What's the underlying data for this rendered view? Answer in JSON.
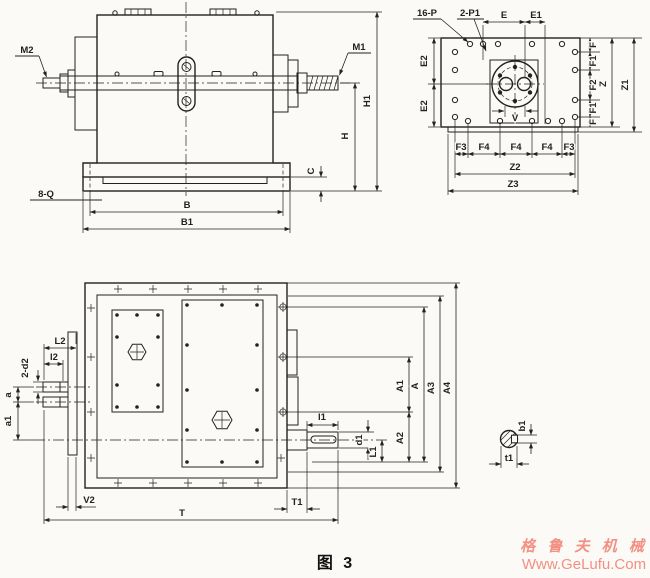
{
  "colors": {
    "line": "#222222",
    "paper": "#fbfaf7",
    "watermark": "#f29082"
  },
  "caption": "图 3",
  "watermark": {
    "brand": "格 鲁 夫 机 械",
    "site": "Www.GeLufu.Com"
  },
  "front_view": {
    "shaft_left": "M2",
    "shaft_right": "M1",
    "height_total": "H1",
    "height_axis": "H",
    "base_thickness": "C",
    "foot_holes": "8-Q",
    "foot_span": "B",
    "base_span": "B1"
  },
  "top_view": {
    "hole_callout": "16-P",
    "pin_callout": "2-P1",
    "e": "E",
    "e1": "E1",
    "e2": [
      "E2",
      "E2"
    ],
    "right_dims": [
      "F",
      "F1",
      "F2",
      "F1",
      "F"
    ],
    "z": "Z",
    "z1": "Z1",
    "bottom_dims": [
      "F3",
      "F4",
      "F4",
      "F4",
      "F3"
    ],
    "z2": "Z2",
    "z3": "Z3",
    "flange_dim": "V"
  },
  "plan_view": {
    "l2_big": "L2",
    "l2_small": "l2",
    "shaft_callout": "2-d2",
    "center_dist_a": "a",
    "center_dist_a1": "a1",
    "flange_thk": "V2",
    "total_len": "T",
    "step_len": "T1",
    "key_len": "l1",
    "shaft_dia": "d1",
    "shaft_len": "L1",
    "a_dims": [
      "A1",
      "A",
      "A3",
      "A4"
    ],
    "a2": "A2"
  },
  "key_detail": {
    "key_width": "b1",
    "key_depth": "t1"
  }
}
